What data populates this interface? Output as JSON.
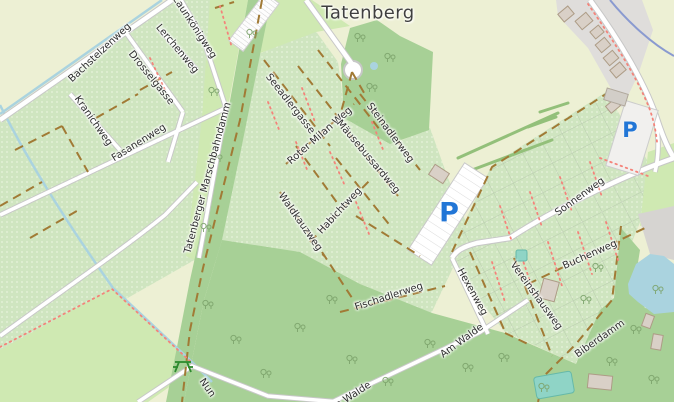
{
  "map": {
    "place_label": "Tatenberg",
    "streets": [
      {
        "name": "Bachstelzenweg",
        "x": 100,
        "y": 53,
        "rot": -43
      },
      {
        "name": "Zaunkönigweg",
        "x": 194,
        "y": 27,
        "rot": 57
      },
      {
        "name": "Lerchenweg",
        "x": 177,
        "y": 49,
        "rot": 50
      },
      {
        "name": "Drosselgasse",
        "x": 151,
        "y": 78,
        "rot": 51
      },
      {
        "name": "Kranichweg",
        "x": 93,
        "y": 121,
        "rot": 55
      },
      {
        "name": "Fasanenweg",
        "x": 139,
        "y": 143,
        "rot": -32
      },
      {
        "name": "Tatenberger Marschbahndamm",
        "x": 208,
        "y": 178,
        "rot": -75
      },
      {
        "name": "Seeadlergasse",
        "x": 290,
        "y": 104,
        "rot": 52
      },
      {
        "name": "Roter Milan Weg",
        "x": 320,
        "y": 136,
        "rot": -41
      },
      {
        "name": "Mäusebussardweg",
        "x": 368,
        "y": 157,
        "rot": 50
      },
      {
        "name": "Steinadlerweg",
        "x": 390,
        "y": 133,
        "rot": 53
      },
      {
        "name": "Waldkauzweg",
        "x": 300,
        "y": 222,
        "rot": 55
      },
      {
        "name": "Habichtweg",
        "x": 340,
        "y": 211,
        "rot": -47
      },
      {
        "name": "Fischadlerweg",
        "x": 389,
        "y": 297,
        "rot": -18
      },
      {
        "name": "Sonnenweg",
        "x": 580,
        "y": 197,
        "rot": -36
      },
      {
        "name": "Hexenweg",
        "x": 472,
        "y": 292,
        "rot": 61
      },
      {
        "name": "Buchenweg",
        "x": 590,
        "y": 255,
        "rot": -24
      },
      {
        "name": "Vereinshausweg",
        "x": 536,
        "y": 296,
        "rot": 54
      },
      {
        "name": "Am Walde",
        "x": 462,
        "y": 341,
        "rot": -36
      },
      {
        "name": "Am Walde",
        "x": 349,
        "y": 398,
        "rot": -33
      },
      {
        "name": "Biberdamm",
        "x": 600,
        "y": 339,
        "rot": -35
      },
      {
        "name": "Nun",
        "x": 207,
        "y": 388,
        "rot": 55
      }
    ],
    "parking_labels": [
      {
        "label": "P",
        "x": 449,
        "y": 213,
        "size": 27
      },
      {
        "label": "P",
        "x": 630,
        "y": 130,
        "size": 21
      }
    ],
    "icons": [
      "tree-icon",
      "picnic-table-icon",
      "parking-p-icon"
    ],
    "colors": {
      "farmland": "#edf0d4",
      "grass": "#cfe9b2",
      "forest": "#a7d096",
      "allotment": "#cfe5c0",
      "residential": "#dfdddb",
      "water": "#aad3df",
      "pond_teal": "#8fd4c6",
      "road": "#ffffff",
      "track": "#a17a35",
      "footpath": "#f4837a",
      "stream": "#8a9ad0",
      "parking_blue": "#2276d6",
      "label_text": "#2f2f2f"
    }
  }
}
